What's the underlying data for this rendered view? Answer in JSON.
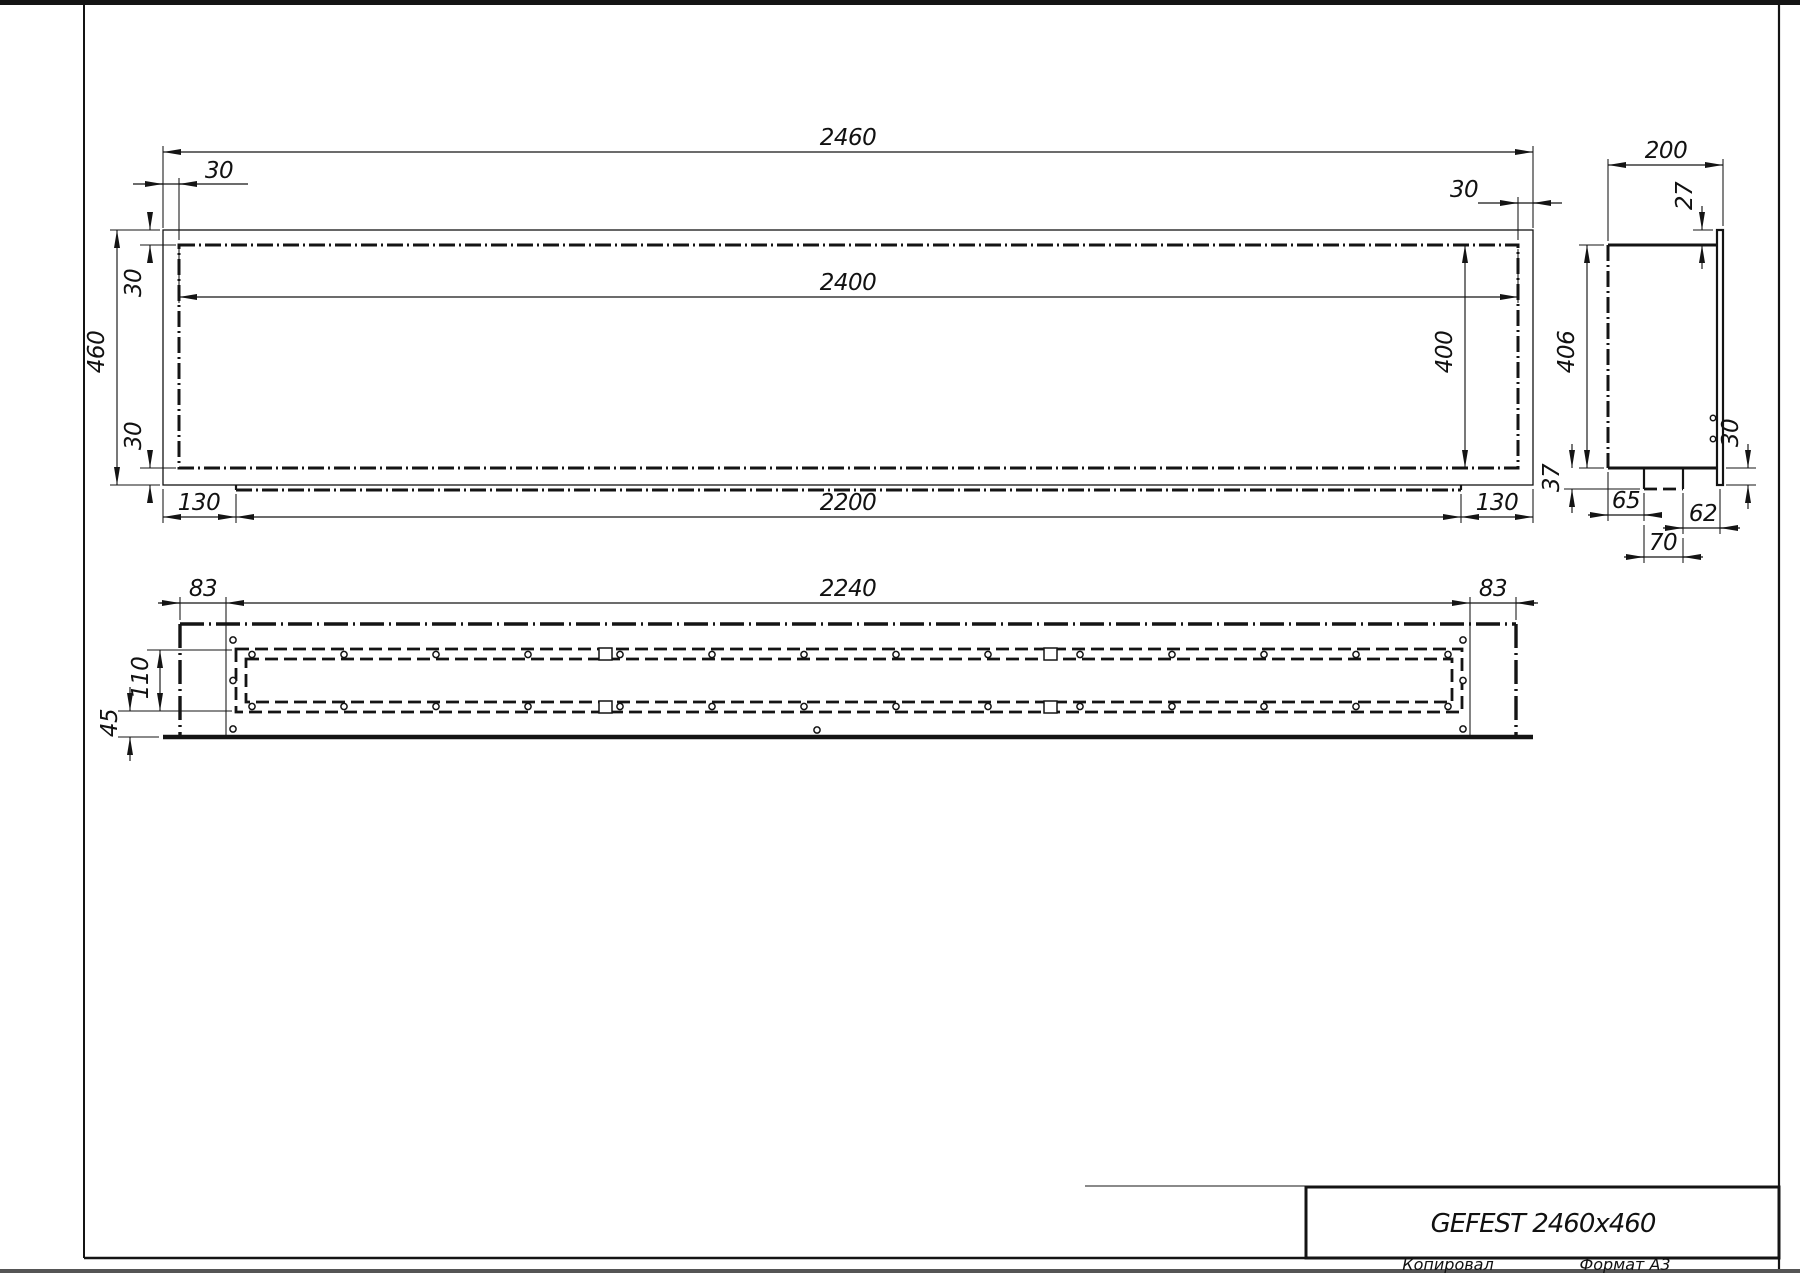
{
  "title_block": {
    "title": "GEFEST 2460x460",
    "copied_label": "Копировал",
    "format_label": "Формат A3"
  },
  "front_view": {
    "dims": {
      "overall_width": "2460",
      "inner_width": "2400",
      "overall_height": "460",
      "inner_height": "400",
      "frame_top_left": "30",
      "frame_top_right": "30",
      "frame_left_top": "30",
      "frame_left_bottom": "30",
      "tray_width": "2200",
      "tray_offset_left": "130",
      "tray_offset_right": "130"
    }
  },
  "side_view": {
    "dims": {
      "depth": "200",
      "lip_top": "27",
      "body_height": "406",
      "tray_depth": "37",
      "tray_front": "65",
      "tray_width": "70",
      "tray_back": "62",
      "lip_bottom": "30"
    }
  },
  "plan_view": {
    "dims": {
      "rail_length": "2240",
      "rail_offset_left": "83",
      "rail_offset_right": "83",
      "rail_width": "110",
      "front_margin": "45"
    }
  }
}
